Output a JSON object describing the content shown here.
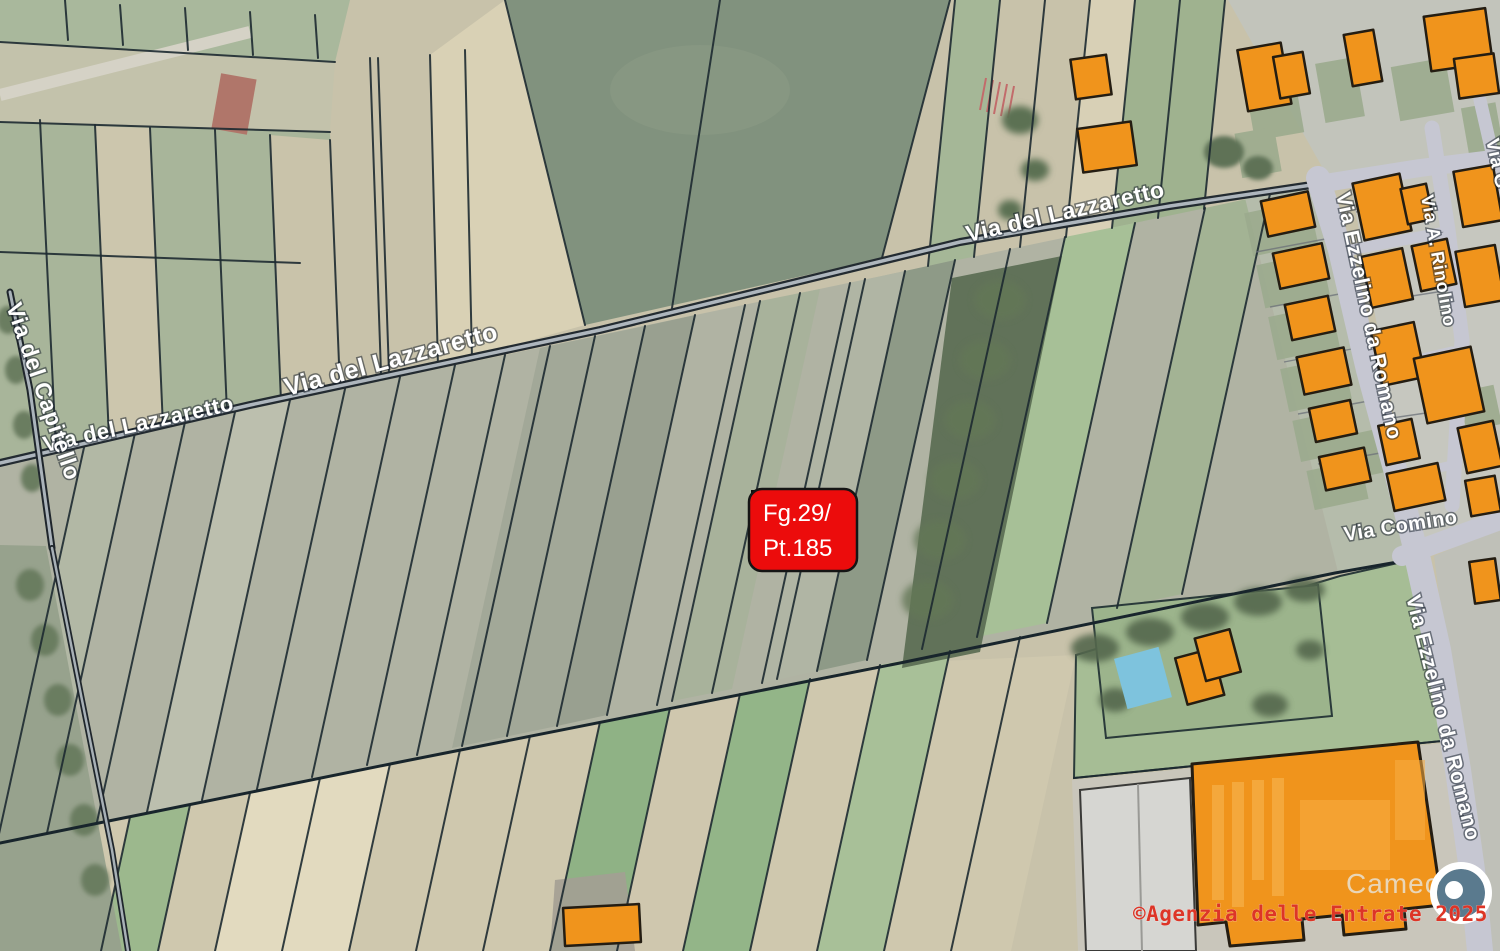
{
  "map": {
    "type": "cadastral-satellite-overlay",
    "parcel_marker": {
      "line1": "Fg.29/",
      "line2": "Pt.185"
    },
    "streets": {
      "lazzaretto_top": "Via del Lazzaretto",
      "lazzaretto_mid": "Via del Lazzaretto",
      "lazzaretto_left": "Via del Lazzaretto",
      "capitello": "Via del Capitello",
      "ezzelino_top": "Via Ezzelino da Romano",
      "ezzelino_bottom": "Via Ezzelino da Romano",
      "comino": "Via Comino",
      "rinolino": "Via A. Rinolino",
      "via_g_partial": "Via G"
    },
    "labels": {
      "business": "Camec"
    },
    "attribution": "©Agenzia delle Entrate 2025",
    "colors": {
      "parcel_marker_bg": "#ec0c0c",
      "parcel_marker_text": "#ffffff",
      "building_orange": "#f0941c",
      "road_urban": "#c6c7d2",
      "attribution_red": "#dd3527",
      "street_label_text": "#ffffff",
      "pool_blue": "#7ec3dd",
      "puck_disc": "#5a7a8e"
    }
  }
}
